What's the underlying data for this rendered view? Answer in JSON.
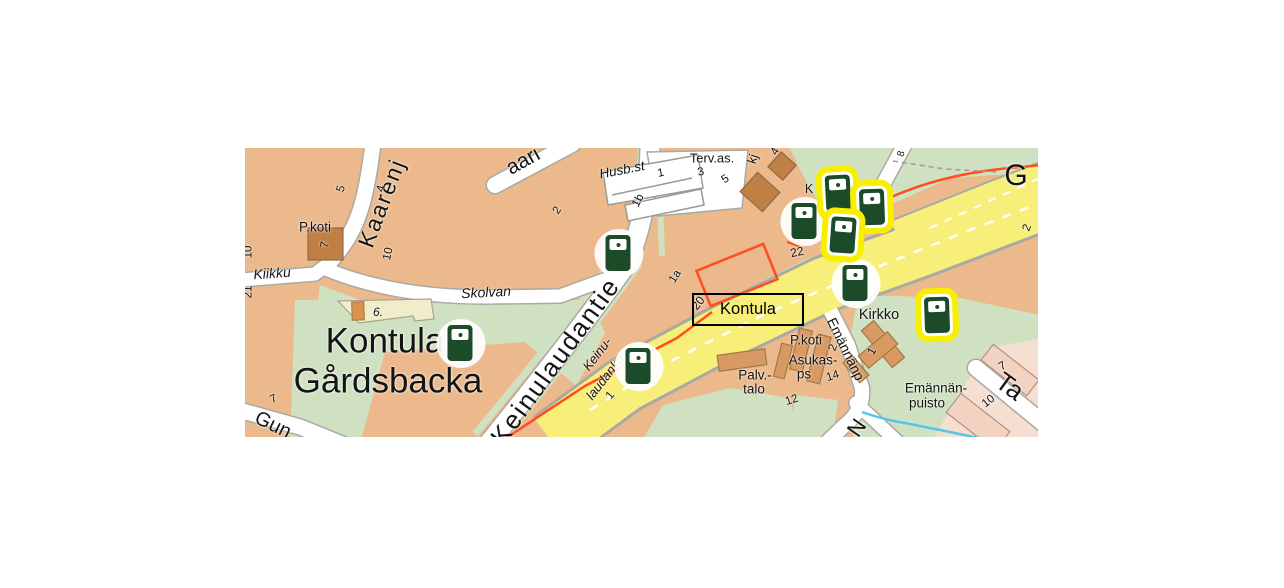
{
  "palette": {
    "base_tan": "#ebb98c",
    "green": "#cfe1c1",
    "road_white": "#ffffff",
    "road_casing": "#a9aaa2",
    "road_yellow": "#f8ef7b",
    "building_tan": "#d89a62",
    "building_brown": "#c07f45",
    "building_cream": "#f0edcb",
    "building_cream_orange": "#d9924f",
    "building_pink": "#f2d2c1",
    "area_pink": "#f5dfd3",
    "metro_orange": "#ff4d1e",
    "stream_cyan": "#55c5e8",
    "marker_green": "#1c4b2a",
    "highlight_yellow": "#f8ee00",
    "text_black": "#141414"
  },
  "station_box": {
    "text": "Kontula",
    "x": 447,
    "y": 145,
    "w": 112,
    "h": 33,
    "size": 16.5
  },
  "labels": [
    {
      "name": "district-name-kontula",
      "text": "Kontula",
      "x": 140,
      "y": 193,
      "size": 35
    },
    {
      "name": "district-name-gardsbacka",
      "text": "Gårdsbacka",
      "x": 143,
      "y": 233,
      "size": 35
    },
    {
      "name": "street-keinulaudantie",
      "text": "Keinulaudantie",
      "x": 310,
      "y": 213,
      "size": 26,
      "rot": -54,
      "ls": 2
    },
    {
      "name": "street-kaarenjalka",
      "text": "Kaarenj",
      "x": 137,
      "y": 55,
      "size": 23,
      "rot": -69,
      "ls": 2
    },
    {
      "name": "street-aari-fragment",
      "text": "aari",
      "x": 278,
      "y": 13,
      "size": 21,
      "rot": -29
    },
    {
      "name": "street-g-fragment",
      "text": "G",
      "x": 771,
      "y": 28,
      "size": 30
    },
    {
      "name": "street-ta-fragment",
      "text": "Ta",
      "x": 765,
      "y": 238,
      "size": 26,
      "rot": 36
    },
    {
      "name": "street-n-fragment",
      "text": "N",
      "x": 612,
      "y": 280,
      "size": 22,
      "rot": -55
    },
    {
      "name": "street-gun-fragment",
      "text": "Gun",
      "x": 28,
      "y": 277,
      "size": 20,
      "rot": 26
    },
    {
      "name": "street-kiikku",
      "text": "Kiikku",
      "x": 27,
      "y": 125,
      "size": 14,
      "rot": -4,
      "italic": true
    },
    {
      "name": "street-skolvan",
      "text": "Skolvan",
      "x": 241,
      "y": 144,
      "size": 14,
      "rot": -3,
      "italic": true
    },
    {
      "name": "street-husbst",
      "text": "Husb.st",
      "x": 377,
      "y": 22,
      "size": 13.5,
      "rot": -11,
      "italic": true
    },
    {
      "name": "street-keinulaudank-line1",
      "text": "Keinu-",
      "x": 352,
      "y": 206,
      "size": 13,
      "rot": -52,
      "italic": true
    },
    {
      "name": "street-keinulaudank-line2",
      "text": "laudanku",
      "x": 360,
      "y": 229,
      "size": 13,
      "rot": -52,
      "italic": true
    },
    {
      "name": "street-emannanp",
      "text": "Emännänp",
      "x": 601,
      "y": 201,
      "size": 14,
      "rot": 64
    },
    {
      "name": "poi-pkoti-northwest",
      "text": "P.koti",
      "x": 70,
      "y": 79,
      "size": 13.5
    },
    {
      "name": "poi-tervas",
      "text": "Terv.as.",
      "x": 467,
      "y": 10,
      "size": 13
    },
    {
      "name": "poi-kirkko",
      "text": "Kirkko",
      "x": 634,
      "y": 167,
      "size": 14.5
    },
    {
      "name": "poi-pkoti-south",
      "text": "P.koti",
      "x": 561,
      "y": 192,
      "size": 13.5
    },
    {
      "name": "poi-asukas-line1",
      "text": "Asukas-",
      "x": 568,
      "y": 212,
      "size": 13.5
    },
    {
      "name": "poi-asukas-line2",
      "text": "ps",
      "x": 559,
      "y": 226,
      "size": 13.5
    },
    {
      "name": "poi-palvtalo-line1",
      "text": "Palv.-",
      "x": 510,
      "y": 227,
      "size": 13.5
    },
    {
      "name": "poi-palvtalo-line2",
      "text": "talo",
      "x": 509,
      "y": 241,
      "size": 13.5
    },
    {
      "name": "poi-emannanpuisto-line1",
      "text": "Emännän-",
      "x": 691,
      "y": 240,
      "size": 13.5
    },
    {
      "name": "poi-emannanpuisto-line2",
      "text": "puisto",
      "x": 682,
      "y": 255,
      "size": 13.5
    },
    {
      "name": "addr-number",
      "text": "5",
      "x": 97,
      "y": 41,
      "size": 11.5,
      "rot": -75
    },
    {
      "name": "addr-number",
      "text": "4",
      "x": 137,
      "y": 41,
      "size": 11.5,
      "rot": -75
    },
    {
      "name": "addr-number",
      "text": "2",
      "x": 313,
      "y": 63,
      "size": 11.5,
      "rot": -55
    },
    {
      "name": "addr-number",
      "text": "7",
      "x": 81,
      "y": 97,
      "size": 11.5,
      "rot": -80
    },
    {
      "name": "addr-number",
      "text": "10",
      "x": 144,
      "y": 106,
      "size": 11.5,
      "rot": -78
    },
    {
      "name": "addr-number",
      "text": "10",
      "x": 4,
      "y": 104,
      "size": 11.5,
      "rot": -90
    },
    {
      "name": "addr-number",
      "text": "21",
      "x": 4,
      "y": 144,
      "size": 11.5,
      "rot": -90
    },
    {
      "name": "addr-number",
      "text": "1",
      "x": 416,
      "y": 26,
      "size": 11.5,
      "rot": -11
    },
    {
      "name": "addr-number",
      "text": "1b",
      "x": 394,
      "y": 53,
      "size": 11.5,
      "rot": -62
    },
    {
      "name": "addr-number",
      "text": "3",
      "x": 456,
      "y": 25,
      "size": 11.5,
      "rot": -12
    },
    {
      "name": "addr-number",
      "text": "5",
      "x": 481,
      "y": 32,
      "size": 11.5,
      "rot": -35
    },
    {
      "name": "street-kj-fragment",
      "text": "kj",
      "x": 508,
      "y": 11,
      "size": 12.5,
      "rot": -72
    },
    {
      "name": "addr-number",
      "text": "4",
      "x": 531,
      "y": 4,
      "size": 11.5,
      "rot": -60
    },
    {
      "name": "street-k-fragment",
      "text": "K",
      "x": 564,
      "y": 41,
      "size": 12.5
    },
    {
      "name": "addr-number",
      "text": "22",
      "x": 552,
      "y": 104,
      "size": 12,
      "rot": -12
    },
    {
      "name": "addr-number",
      "text": "2",
      "x": 783,
      "y": 80,
      "size": 11.5,
      "rot": -68
    },
    {
      "name": "addr-number",
      "text": "8",
      "x": 657,
      "y": 6,
      "size": 10,
      "rot": -75
    },
    {
      "name": "addr-number",
      "text": "6.",
      "x": 133,
      "y": 164,
      "size": 12,
      "italic": true
    },
    {
      "name": "addr-number",
      "text": "20",
      "x": 453,
      "y": 155,
      "size": 12,
      "rot": -52
    },
    {
      "name": "addr-number",
      "text": "1a",
      "x": 431,
      "y": 129,
      "size": 11.5,
      "rot": -58
    },
    {
      "name": "addr-number",
      "text": "2",
      "x": 589,
      "y": 200,
      "size": 11.5,
      "rot": -70
    },
    {
      "name": "addr-number",
      "text": "14",
      "x": 588,
      "y": 229,
      "size": 11.5,
      "rot": -18
    },
    {
      "name": "addr-number",
      "text": "12",
      "x": 547,
      "y": 253,
      "size": 11.5,
      "rot": -18
    },
    {
      "name": "addr-number",
      "text": "1",
      "x": 628,
      "y": 204,
      "size": 11.5,
      "rot": -60
    },
    {
      "name": "addr-number",
      "text": "1",
      "x": 366,
      "y": 248,
      "size": 11.5,
      "rot": -50
    },
    {
      "name": "addr-number",
      "text": "7",
      "x": 758,
      "y": 219,
      "size": 11.5,
      "rot": -30
    },
    {
      "name": "addr-number",
      "text": "10",
      "x": 744,
      "y": 254,
      "size": 11.5,
      "rot": -38
    },
    {
      "name": "addr-number",
      "text": "7",
      "x": 29,
      "y": 252,
      "size": 11.5,
      "rot": -25
    }
  ],
  "markers": [
    {
      "x": 373,
      "y": 105,
      "highlighted": false
    },
    {
      "x": 215,
      "y": 195,
      "highlighted": false
    },
    {
      "x": 393,
      "y": 218,
      "highlighted": false
    },
    {
      "x": 559,
      "y": 73,
      "highlighted": false
    },
    {
      "x": 610,
      "y": 135,
      "highlighted": false
    },
    {
      "x": 593,
      "y": 45,
      "highlighted": true,
      "tilt": -3
    },
    {
      "x": 627,
      "y": 59,
      "highlighted": true,
      "tilt": -2
    },
    {
      "x": 598,
      "y": 87,
      "highlighted": true,
      "tilt": 4
    },
    {
      "x": 692,
      "y": 167,
      "highlighted": true,
      "tilt": -2
    }
  ]
}
